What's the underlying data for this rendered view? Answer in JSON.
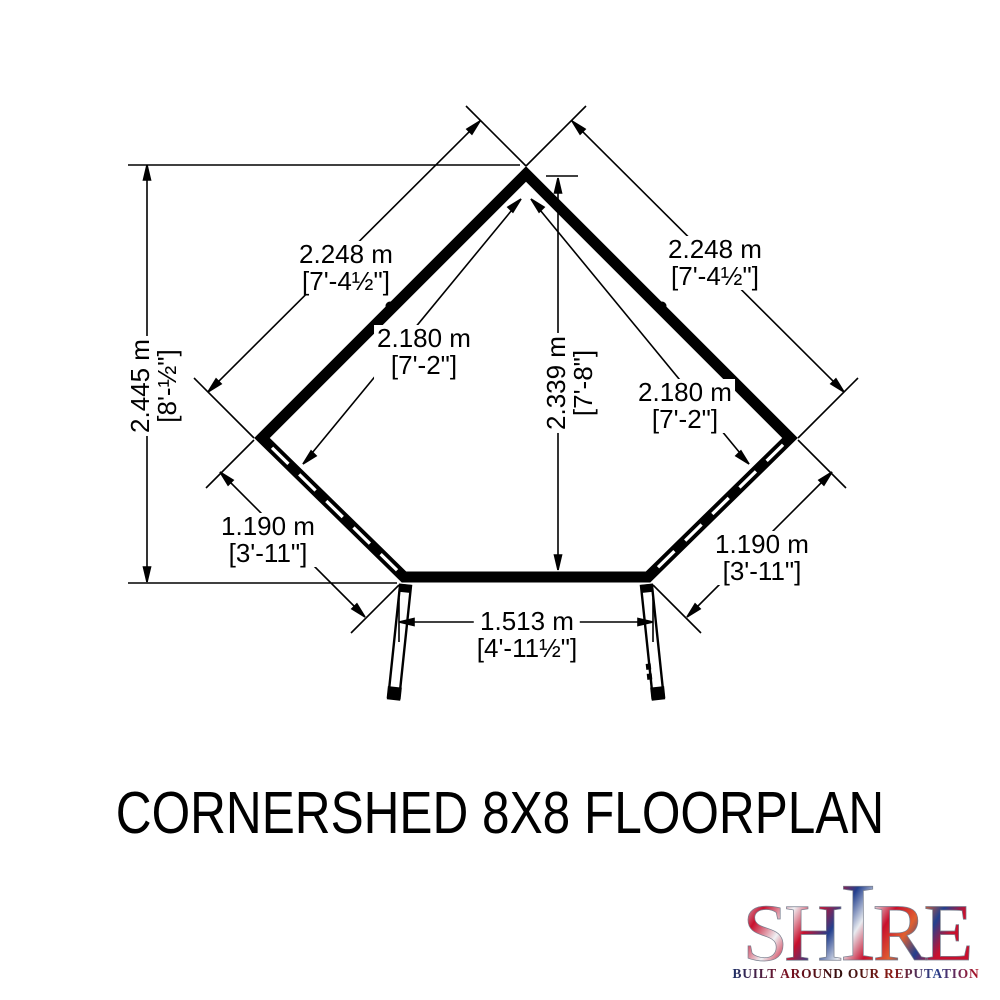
{
  "title": "CORNERSHED 8X8 FLOORPLAN",
  "logo": {
    "word_start": "SH",
    "word_tall": "I",
    "word_end": "RE",
    "tagline": "BUILT AROUND OUR REPUTATION",
    "flag_colors": {
      "blue": "#23408e",
      "red": "#c8102e",
      "white": "#eef0f4"
    }
  },
  "floorplan": {
    "shape": "corner shed pentagon, double doors open at front",
    "wall_color": "#000000",
    "background_color": "#ffffff",
    "dimensions": {
      "left_wall": {
        "metric": "2.248 m",
        "imperial": "[7'-4½\"]"
      },
      "right_wall": {
        "metric": "2.248 m",
        "imperial": "[7'-4½\"]"
      },
      "left_wall_interior": {
        "metric": "2.180 m",
        "imperial": "[7'-2\"]"
      },
      "right_wall_interior": {
        "metric": "2.180 m",
        "imperial": "[7'-2\"]"
      },
      "overall_depth": {
        "metric": "2.445 m",
        "imperial": "[8'-½\"]"
      },
      "interior_depth": {
        "metric": "2.339 m",
        "imperial": "[7'-8\"]"
      },
      "front_left": {
        "metric": "1.190 m",
        "imperial": "[3'-11\"]"
      },
      "front_right": {
        "metric": "1.190 m",
        "imperial": "[3'-11\"]"
      },
      "door_opening": {
        "metric": "1.513 m",
        "imperial": "[4'-11½\"]"
      }
    }
  }
}
